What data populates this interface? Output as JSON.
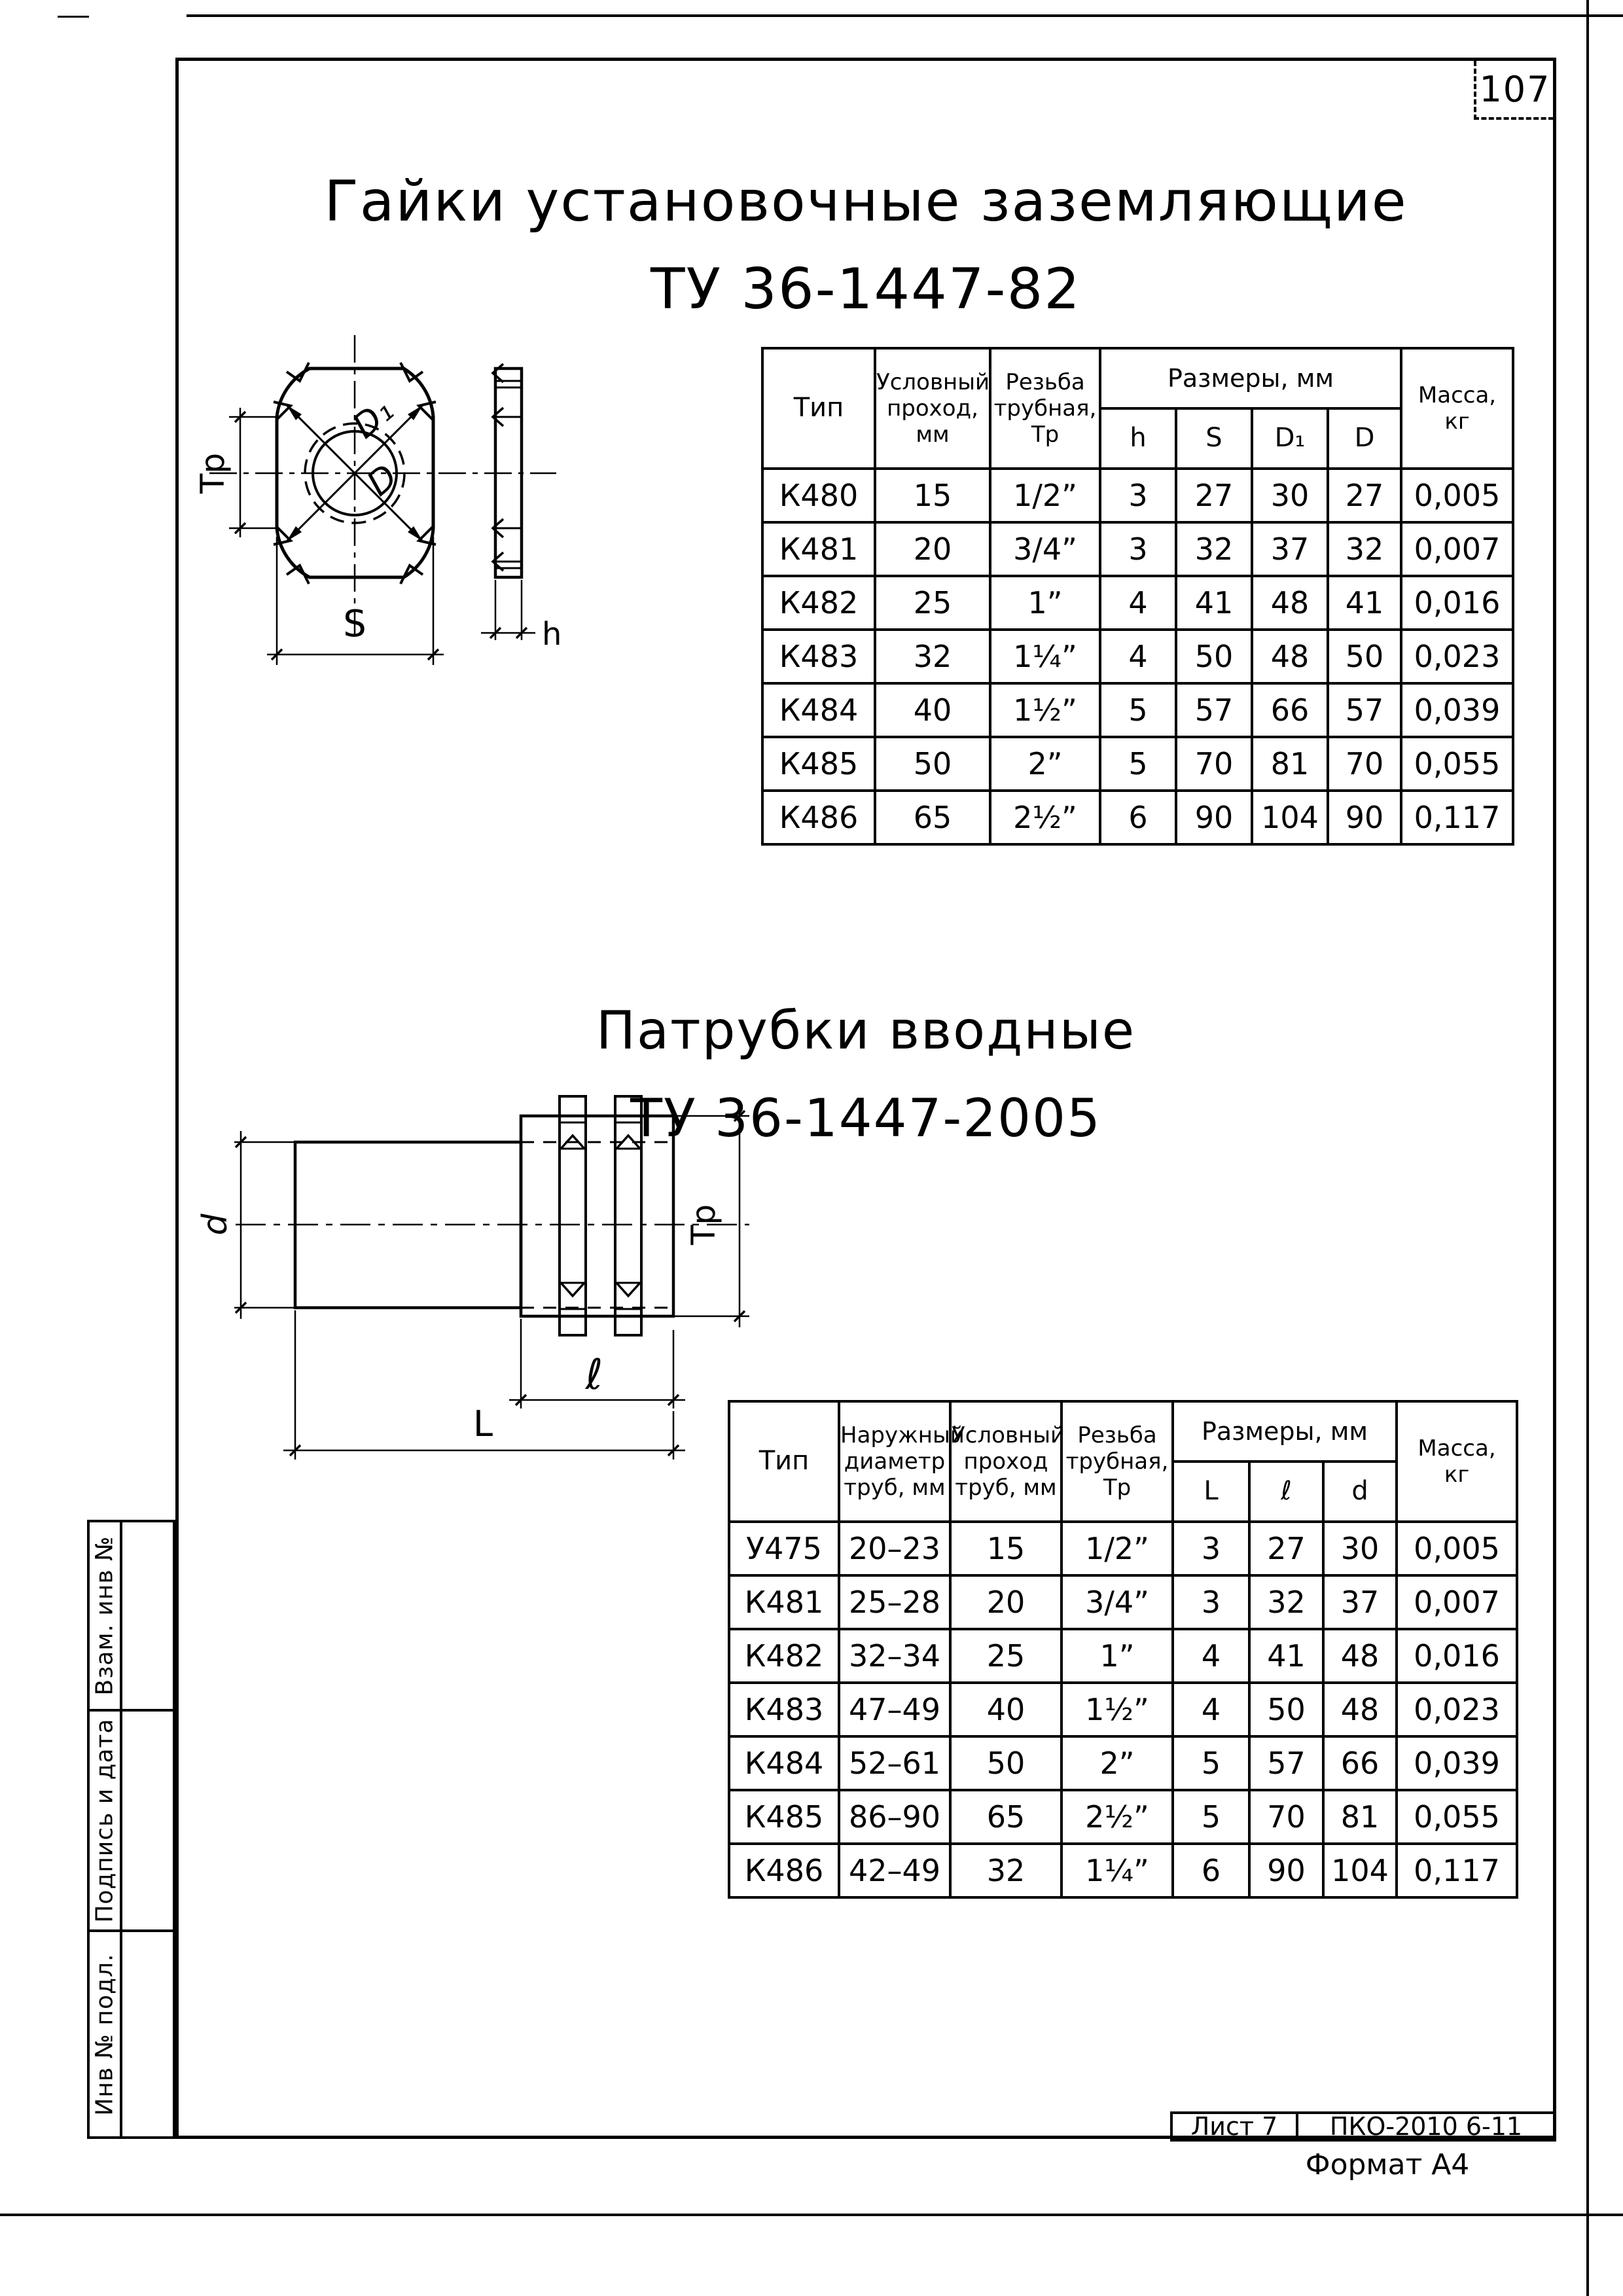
{
  "page": {
    "number": "107",
    "footer": {
      "sheet": "Лист 7",
      "code": "ПКО-2010 6-11",
      "format": "Формат А4"
    },
    "sidebar": {
      "cell1": "Взам. инв №",
      "cell2": "Подпись и дата",
      "cell3": "Инв № подл."
    }
  },
  "section1": {
    "title": "Гайки установочные заземляющие",
    "subtitle": "ТУ 36-1447-82",
    "drawing_labels": {
      "tp": "Тр",
      "s": "S",
      "d1": "D₁",
      "d": "D",
      "h": "h"
    },
    "table": {
      "col_type": "Тип",
      "col_pass": "Условный\nпроход,\nмм",
      "col_thread": "Резьба\nтрубная,\nТр",
      "col_sizes": "Размеры, мм",
      "size_cols": [
        "h",
        "S",
        "D₁",
        "D"
      ],
      "col_mass": "Масса,\nкг",
      "rows": [
        [
          "К480",
          "15",
          "1/2”",
          "3",
          "27",
          "30",
          "27",
          "0,005"
        ],
        [
          "К481",
          "20",
          "3/4”",
          "3",
          "32",
          "37",
          "32",
          "0,007"
        ],
        [
          "К482",
          "25",
          "1”",
          "4",
          "41",
          "48",
          "41",
          "0,016"
        ],
        [
          "К483",
          "32",
          "1¼”",
          "4",
          "50",
          "48",
          "50",
          "0,023"
        ],
        [
          "К484",
          "40",
          "1½”",
          "5",
          "57",
          "66",
          "57",
          "0,039"
        ],
        [
          "К485",
          "50",
          "2”",
          "5",
          "70",
          "81",
          "70",
          "0,055"
        ],
        [
          "К486",
          "65",
          "2½”",
          "6",
          "90",
          "104",
          "90",
          "0,117"
        ]
      ]
    }
  },
  "section2": {
    "title": "Патрубки вводные",
    "subtitle": "ТУ 36-1447-2005",
    "drawing_labels": {
      "d": "d",
      "tp": "Тр",
      "l_small": "ℓ",
      "l_big": "L"
    },
    "table": {
      "col_type": "Тип",
      "col_outer": "Наружный\nдиаметр\nтруб, мм",
      "col_pass": "Условный\nпроход\nтруб, мм",
      "col_thread": "Резьба\nтрубная,\nТр",
      "col_sizes": "Размеры, мм",
      "size_cols": [
        "L",
        "ℓ",
        "d"
      ],
      "col_mass": "Масса,\nкг",
      "rows": [
        [
          "У475",
          "20–23",
          "15",
          "1/2”",
          "3",
          "27",
          "30",
          "0,005"
        ],
        [
          "К481",
          "25–28",
          "20",
          "3/4”",
          "3",
          "32",
          "37",
          "0,007"
        ],
        [
          "К482",
          "32–34",
          "25",
          "1”",
          "4",
          "41",
          "48",
          "0,016"
        ],
        [
          "К483",
          "47–49",
          "40",
          "1½”",
          "4",
          "50",
          "48",
          "0,023"
        ],
        [
          "К484",
          "52–61",
          "50",
          "2”",
          "5",
          "57",
          "66",
          "0,039"
        ],
        [
          "К485",
          "86–90",
          "65",
          "2½”",
          "5",
          "70",
          "81",
          "0,055"
        ],
        [
          "К486",
          "42–49",
          "32",
          "1¼”",
          "6",
          "90",
          "104",
          "0,117"
        ]
      ]
    }
  }
}
